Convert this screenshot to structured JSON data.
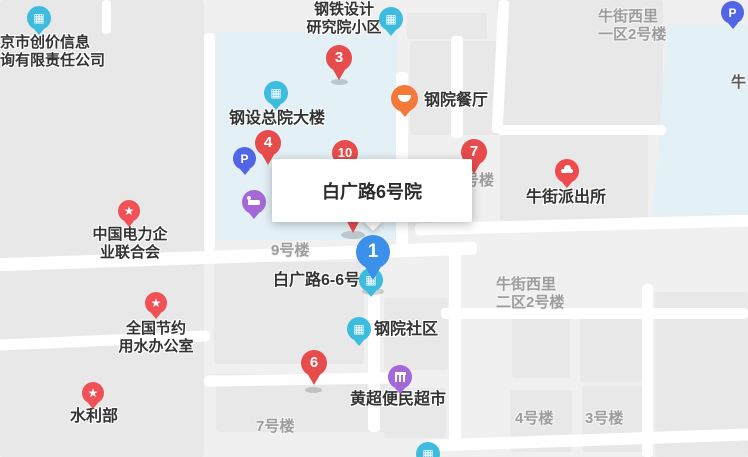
{
  "info_box": {
    "title": "白广路6号院"
  },
  "pins": {
    "p1": {
      "label": "1",
      "color": "#3b90ea"
    },
    "p3": {
      "label": "3",
      "color": "#e74c4c"
    },
    "p4": {
      "label": "4",
      "color": "#e74c4c"
    },
    "p6": {
      "label": "6",
      "color": "#e74c4c"
    },
    "p7": {
      "label": "7",
      "color": "#e74c4c"
    },
    "p10": {
      "label": "10",
      "color": "#e74c4c"
    }
  },
  "pois": [
    {
      "id": "bj-chuangjia-company",
      "label": "京市创价信息\n询有限责任公司",
      "icon": "building-icon"
    },
    {
      "id": "steel-design-compound",
      "label": "钢铁设计\n研究院小区",
      "icon": "building-icon"
    },
    {
      "id": "gangshe-headquarters",
      "label": "钢设总院大楼",
      "icon": "building-icon"
    },
    {
      "id": "gangyuan-restaurant",
      "label": "钢院餐厅",
      "icon": "restaurant-icon"
    },
    {
      "id": "china-electricity-council",
      "label": "中国电力企\n业联合会",
      "icon": "star-icon"
    },
    {
      "id": "niujie-police-station",
      "label": "牛街派出所",
      "icon": "police-cap-icon"
    },
    {
      "id": "water-saving-office",
      "label": "全国节约\n用水办公室",
      "icon": "star-icon"
    },
    {
      "id": "ministry-of-water-resources",
      "label": "水利部",
      "icon": "star-icon"
    },
    {
      "id": "gangyuan-community",
      "label": "钢院社区",
      "icon": "building-icon"
    },
    {
      "id": "huangchao-supermarket",
      "label": "黄超便民超市",
      "icon": "shop-icon"
    },
    {
      "id": "baiguanglu-6-6",
      "label": "白广路6-6号",
      "icon": "building-icon"
    }
  ],
  "unlabeled_markers": [
    {
      "id": "parking-west",
      "icon": "parking-icon"
    },
    {
      "id": "hotel-marker",
      "icon": "bed-icon"
    },
    {
      "id": "parking-northeast",
      "icon": "parking-icon"
    },
    {
      "id": "poi-partial-south",
      "icon": "building-icon"
    }
  ],
  "area_labels": [
    {
      "id": "niujie-xili-yiqu",
      "label": "牛街西里\n一区2号楼"
    },
    {
      "id": "niu-street-fragment",
      "label": "牛"
    },
    {
      "id": "building-9",
      "label": "9号楼"
    },
    {
      "id": "building-fragment",
      "label": "号楼"
    },
    {
      "id": "niujie-xili-erqu",
      "label": "牛街西里\n二区2号楼"
    },
    {
      "id": "building-7",
      "label": "7号楼"
    },
    {
      "id": "building-4",
      "label": "4号楼"
    },
    {
      "id": "building-3",
      "label": "3号楼"
    }
  ],
  "icon_glyphs": {
    "building": "▦",
    "star": "★",
    "parking": "P"
  },
  "colors": {
    "pin_red": "#e74c4c",
    "pin_blue": "#3b90ea",
    "poi_cyan": "#3ebcdf",
    "poi_orange": "#f4793b",
    "poi_purple": "#a468d8",
    "poi_parking": "#5165e6",
    "poi_star_red": "#ee5257",
    "highlight_zone": "#e3f0f6",
    "block_gray": "#e8e8e8",
    "road_white": "#ffffff",
    "label_dark": "#333333",
    "label_gray": "#9d9d9d"
  }
}
